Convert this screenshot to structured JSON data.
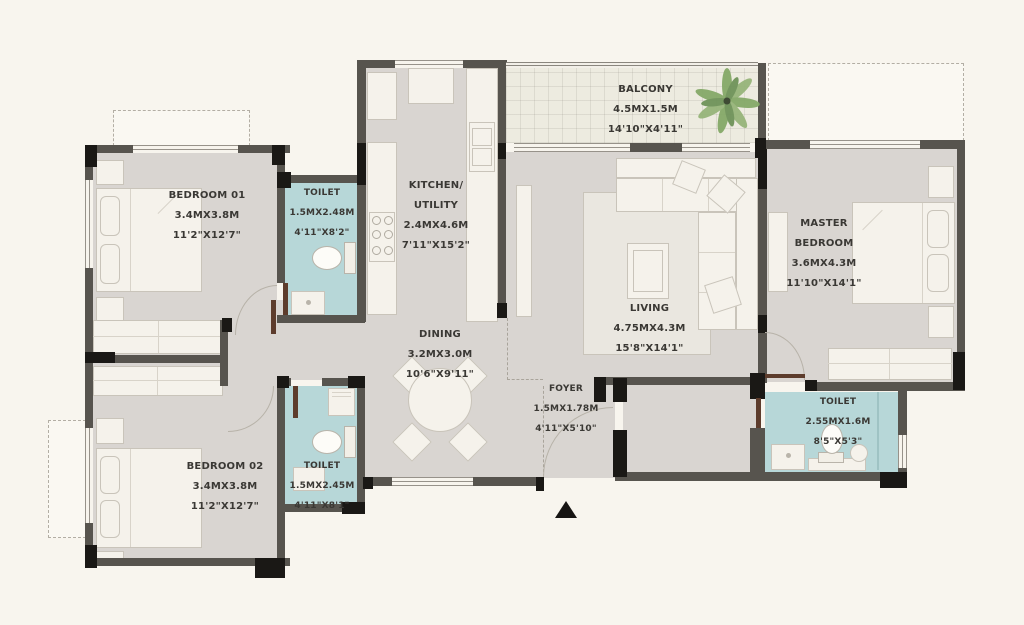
{
  "rooms": [
    {
      "id": "bedroom-01",
      "name": "BEDROOM 01",
      "metric": "3.4MX3.8M",
      "imperial": "11'2\"X12'7\""
    },
    {
      "id": "toilet-1",
      "name": "TOILET",
      "metric": "1.5MX2.48M",
      "imperial": "4'11\"X8'2\""
    },
    {
      "id": "kitchen-utility",
      "name": "KITCHEN/",
      "name2": "UTILITY",
      "metric": "2.4MX4.6M",
      "imperial": "7'11\"X15'2\""
    },
    {
      "id": "balcony",
      "name": "BALCONY",
      "metric": "4.5MX1.5M",
      "imperial": "14'10\"X4'11\""
    },
    {
      "id": "living",
      "name": "LIVING",
      "metric": "4.75MX4.3M",
      "imperial": "15'8\"X14'1\""
    },
    {
      "id": "master-bedroom",
      "name": "MASTER",
      "name2": "BEDROOM",
      "metric": "3.6MX4.3M",
      "imperial": "11'10\"X14'1\""
    },
    {
      "id": "dining",
      "name": "DINING",
      "metric": "3.2MX3.0M",
      "imperial": "10'6\"X9'11\""
    },
    {
      "id": "foyer",
      "name": "FOYER",
      "metric": "1.5MX1.78M",
      "imperial": "4'11\"X5'10\""
    },
    {
      "id": "toilet-2",
      "name": "TOILET",
      "metric": "2.55MX1.6M",
      "imperial": "8'5\"X5'3\""
    },
    {
      "id": "bedroom-02",
      "name": "BEDROOM 02",
      "metric": "3.4MX3.8M",
      "imperial": "11'2\"X12'7\""
    },
    {
      "id": "toilet-3",
      "name": "TOILET",
      "metric": "1.5MX2.45M",
      "imperial": "4'11\"X8'1\""
    }
  ],
  "colors": {
    "background": "#f8f5ee",
    "floor": "#d9d5d1",
    "toilet_floor": "#b7d7d8",
    "balcony_floor": "#edebe0",
    "wall": "#57544e",
    "wall_accent": "#1a1815",
    "furniture": "#f5f2eb",
    "door_leaf": "#5d3c2c",
    "plant_green": "#85a968",
    "text": "#3a3834"
  }
}
